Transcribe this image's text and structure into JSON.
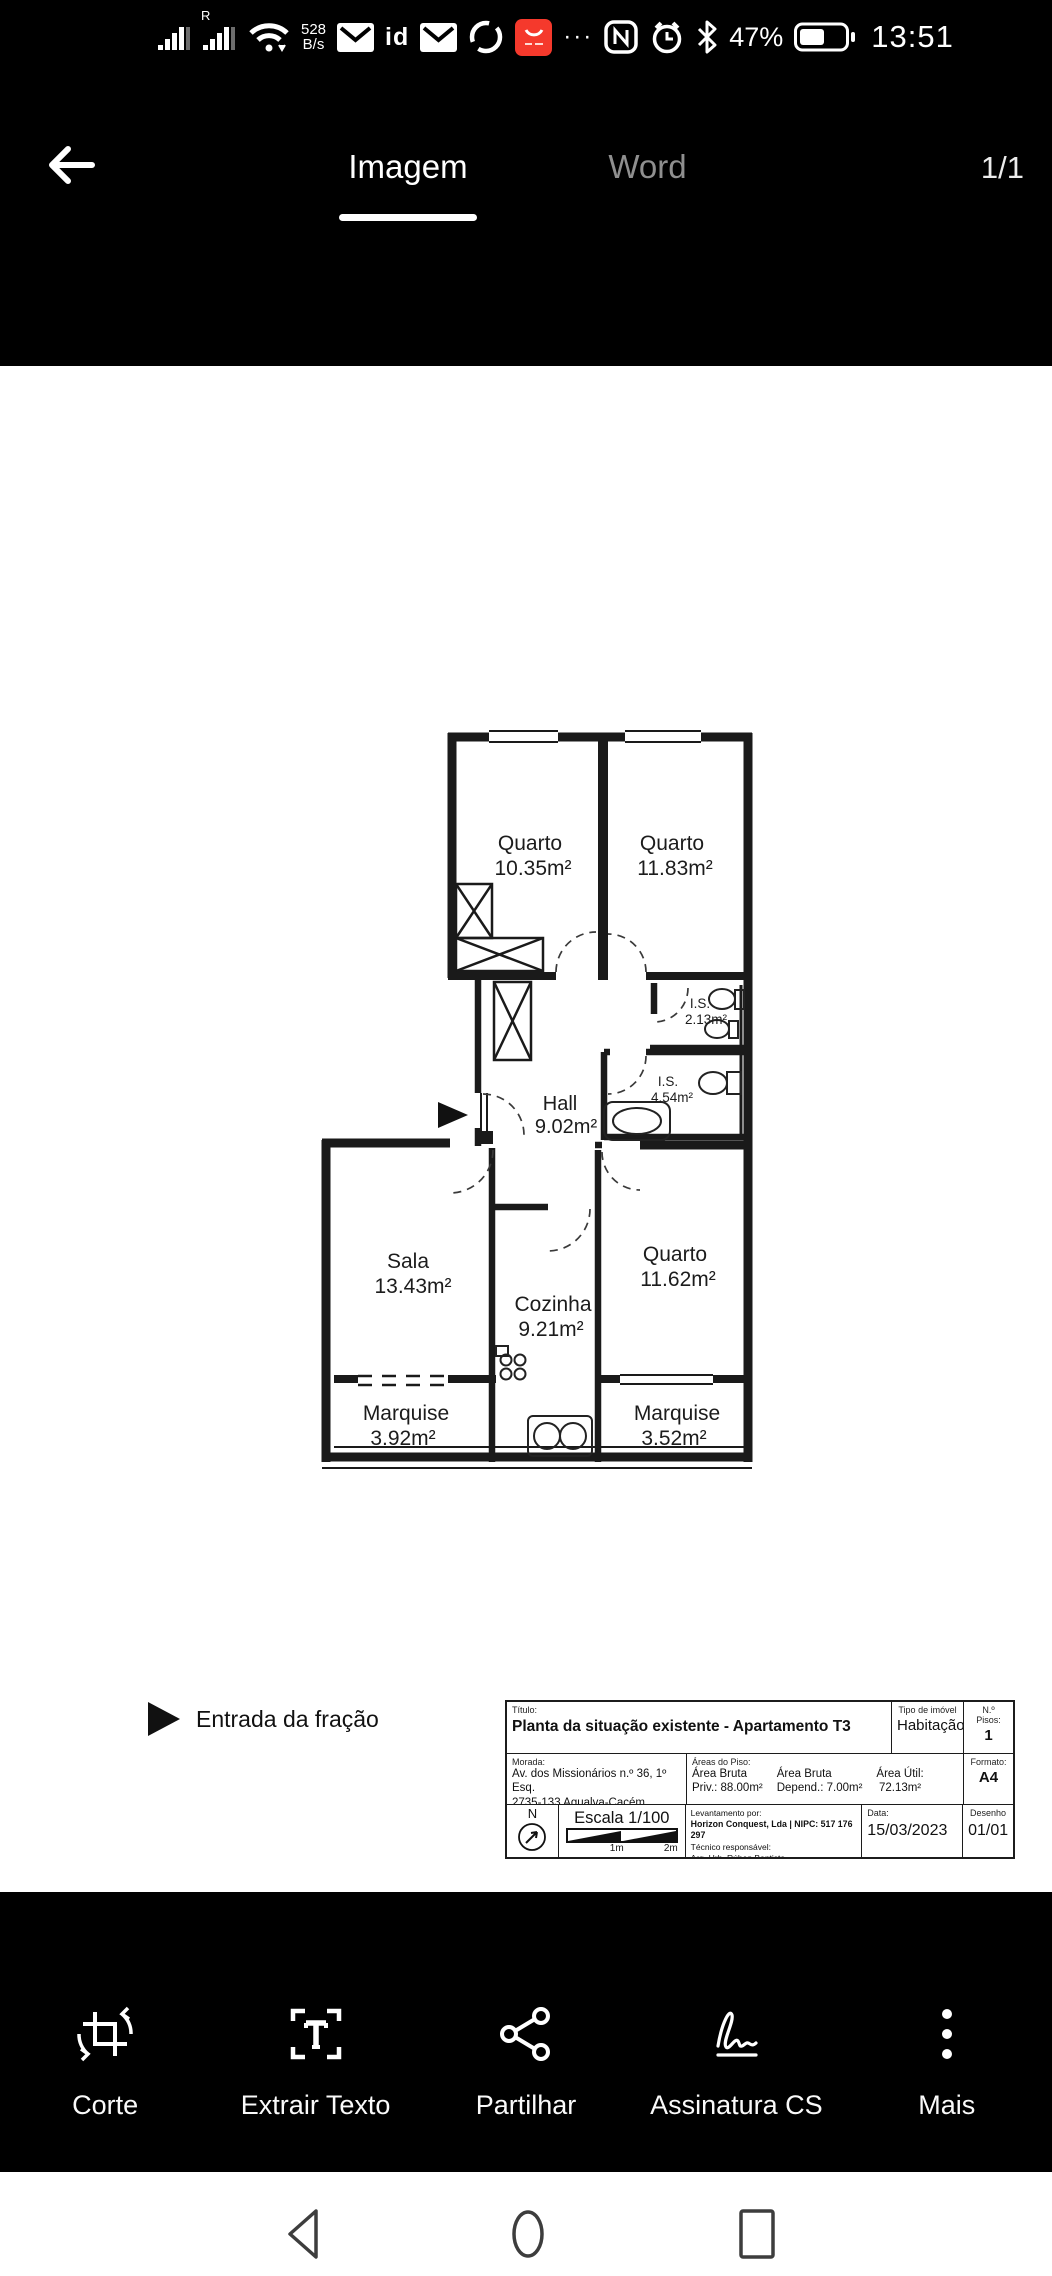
{
  "status_bar": {
    "roaming": "R",
    "speed_value": "528",
    "speed_unit": "B/s",
    "id_badge": "id",
    "overflow_dots": "···",
    "battery_percent": "47%",
    "time": "13:51",
    "badge_color": "#f5392c"
  },
  "header": {
    "tabs": [
      {
        "label": "Imagem",
        "active": true
      },
      {
        "label": "Word",
        "active": false
      }
    ],
    "page_indicator": "1/1"
  },
  "plan": {
    "rooms": [
      {
        "name": "Quarto",
        "area": "10.35m²"
      },
      {
        "name": "Quarto",
        "area": "11.83m²"
      },
      {
        "name": "I.S.",
        "area": "2.13m²"
      },
      {
        "name": "I.S.",
        "area": "4.54m²"
      },
      {
        "name": "Hall",
        "area": "9.02m²"
      },
      {
        "name": "Sala",
        "area": "13.43m²"
      },
      {
        "name": "Cozinha",
        "area": "9.21m²"
      },
      {
        "name": "Quarto",
        "area": "11.62m²"
      },
      {
        "name": "Marquise",
        "area": "3.92m²"
      },
      {
        "name": "Marquise",
        "area": "3.52m²"
      }
    ],
    "legend": {
      "entrance_label": "Entrada da fração"
    },
    "title_block": {
      "title_label": "Título:",
      "title": "Planta da situação existente - Apartamento T3",
      "property_type_label": "Tipo de imóvel",
      "property_type": "Habitação",
      "floors_label": "N.º Pisos:",
      "floors": "1",
      "address_label": "Morada:",
      "address_line1": "Av. dos Missionários n.º 36, 1º Esq.",
      "address_line2": "2735-133 Agualva-Cacém, Sintra",
      "areas_label": "Áreas do Piso:",
      "area_bruta_label": "Área Bruta",
      "area_bruta_value": "Priv.: 88.00m²",
      "area_depend_label": "Área Bruta",
      "area_depend_value": "Depend.: 7.00m²",
      "area_util_label": "Área Útil:",
      "area_util_value": "72.13m²",
      "format_label": "Formato:",
      "format": "A4",
      "compass_letter": "N",
      "scale_label": "Escala 1/100",
      "scale_tick1": "1m",
      "scale_tick2": "2m",
      "survey_label": "Levantamento por:",
      "survey_company": "Horizon Conquest, Lda | NIPC: 517 176 297",
      "technician_label": "Técnico responsável:",
      "technician": "Arq. Urb. Rúben Baptista",
      "date_label": "Data:",
      "date": "15/03/2023",
      "drawing_label": "Desenho",
      "drawing": "01/01"
    }
  },
  "toolbar": {
    "items": [
      {
        "label": "Corte",
        "icon": "crop-icon"
      },
      {
        "label": "Extrair Texto",
        "icon": "extract-text-icon"
      },
      {
        "label": "Partilhar",
        "icon": "share-icon"
      },
      {
        "label": "Assinatura CS",
        "icon": "signature-icon"
      },
      {
        "label": "Mais",
        "icon": "more-icon"
      }
    ]
  }
}
